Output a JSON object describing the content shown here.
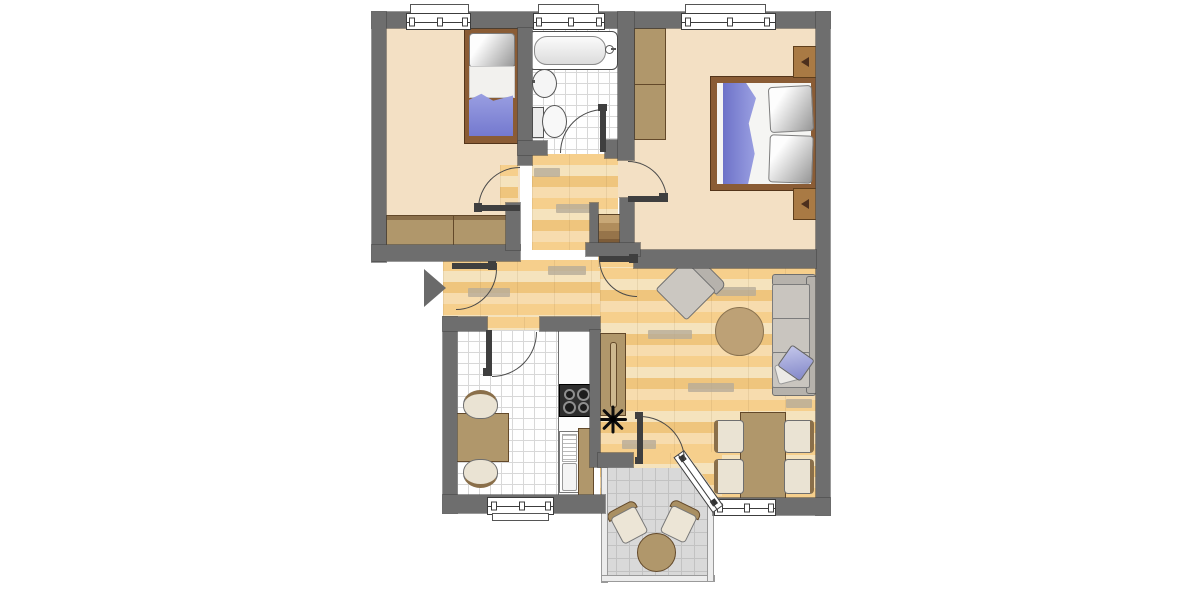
{
  "meta": {
    "title": "Apartment floor plan",
    "type": "architectural-floor-plan",
    "orientation": "top-down"
  },
  "palette": {
    "wall_gray": "#6e6e6e",
    "room_beige": "#f3e0c4",
    "parquet_tan": "#f4d8a2",
    "tile_white": "#ffffff",
    "balcony_gray": "#d9d9d9",
    "furniture_brown": "#b0976b",
    "bed_frame_brown": "#8a5c35",
    "textile_blue": "#8187d6",
    "upholstery_gray": "#c9c5bf",
    "rug_tan": "#bda176"
  },
  "rooms": [
    {
      "id": "bedroom-small",
      "name": "Small bedroom",
      "floor": "beige",
      "furniture": [
        "single-bed",
        "wardrobe"
      ]
    },
    {
      "id": "bathroom",
      "name": "Bathroom",
      "floor": "white-tile",
      "furniture": [
        "bathtub",
        "washbasin",
        "toilet"
      ]
    },
    {
      "id": "bedroom-main",
      "name": "Main bedroom",
      "floor": "beige",
      "furniture": [
        "double-bed",
        "wardrobe",
        "nightstand-with-lamp",
        "nightstand-with-lamp"
      ]
    },
    {
      "id": "hallway",
      "name": "Hallway",
      "floor": "parquet",
      "furniture": [
        "shoe-rack"
      ]
    },
    {
      "id": "kitchen",
      "name": "Kitchen",
      "floor": "white-tile",
      "furniture": [
        "small-table",
        "chair",
        "chair",
        "countertop",
        "stove-4-burner",
        "sink-unit"
      ]
    },
    {
      "id": "living-room",
      "name": "Living room",
      "floor": "parquet",
      "furniture": [
        "armchair",
        "round-rug",
        "sofa-3-seat",
        "blue-pillow",
        "dining-table",
        "chair",
        "chair",
        "chair",
        "chair",
        "sideboard",
        "plant"
      ]
    },
    {
      "id": "balcony",
      "name": "Balcony",
      "floor": "gray-tile",
      "furniture": [
        "bistro-table",
        "chair",
        "chair"
      ]
    }
  ],
  "openings": {
    "entrance": "west side, marked with arrow",
    "interior_doors": [
      "bedroom-small",
      "bathroom",
      "bedroom-main",
      "kitchen",
      "living-room",
      "balcony"
    ],
    "windows": [
      "bedroom-small-north",
      "bathroom-north",
      "bedroom-main-north",
      "kitchen-south",
      "living-room-south",
      "balcony-diagonal-glazing"
    ]
  },
  "entry_marker": "right-pointing-arrow"
}
